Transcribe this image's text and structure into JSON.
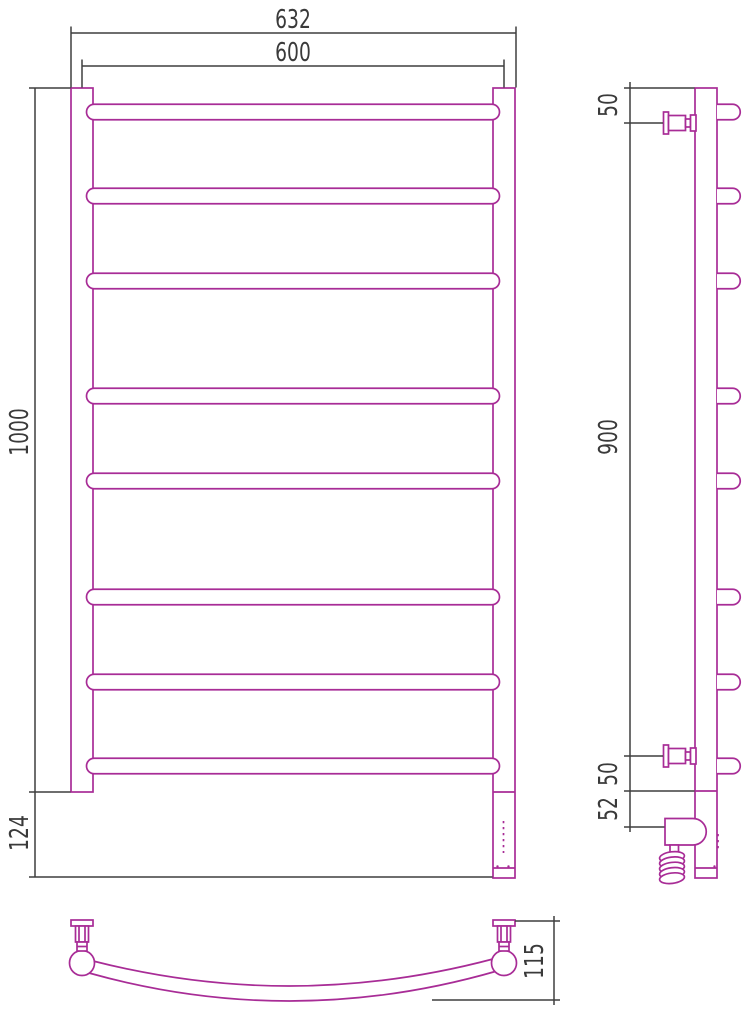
{
  "drawing": {
    "type_label": "towel-rail-technical-drawing",
    "colors": {
      "outline": "#a82c96",
      "dimension": "#3f3f3f",
      "background": "#ffffff"
    },
    "front_view": {
      "dim_width_overall": "632",
      "dim_width_axes": "600",
      "dim_height": "1000",
      "dim_bottom_section": "124",
      "rung_count": 8
    },
    "side_view": {
      "dim_top_offset": "50",
      "dim_connection_span": "900",
      "dim_bottom_offset": "50",
      "dim_heater_offset": "52"
    },
    "top_view": {
      "dim_depth": "115"
    }
  }
}
